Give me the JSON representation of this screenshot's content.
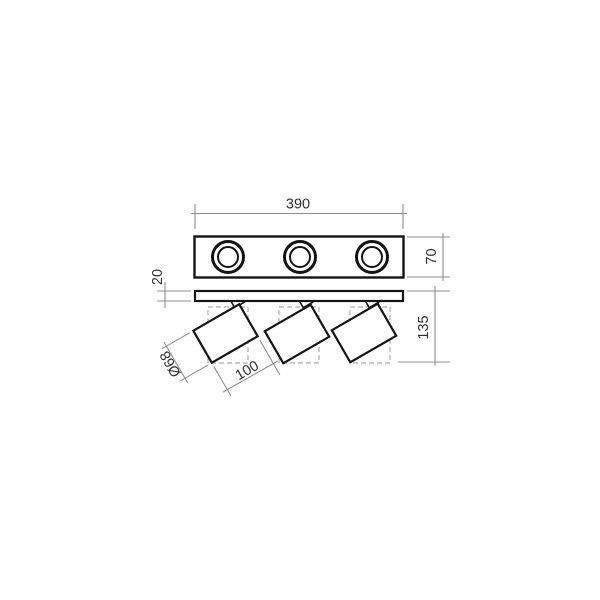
{
  "product_drawing": {
    "type": "technical dimension drawing",
    "subject": "3-light ceiling spotlight rail",
    "views": {
      "top_view": {
        "name": "top view",
        "spot_count": 3
      },
      "side_view": {
        "name": "side view",
        "spot_count": 3
      }
    },
    "dimensions": {
      "rail_width": {
        "label": "390",
        "orientation": "horizontal"
      },
      "plate_depth": {
        "label": "70",
        "orientation": "vertical"
      },
      "base_thickness": {
        "label": "20",
        "orientation": "vertical"
      },
      "overall_height": {
        "label": "135",
        "orientation": "vertical"
      },
      "head_diameter": {
        "label": "Ø68",
        "orientation": "diagonal"
      },
      "head_length": {
        "label": "100",
        "orientation": "diagonal"
      }
    },
    "colors": {
      "outline": "#141414",
      "dimension_line": "#8f8f8f",
      "dimension_text": "#2f2f2f",
      "hidden_line": "#aeaeae",
      "background": "#ffffff"
    }
  }
}
